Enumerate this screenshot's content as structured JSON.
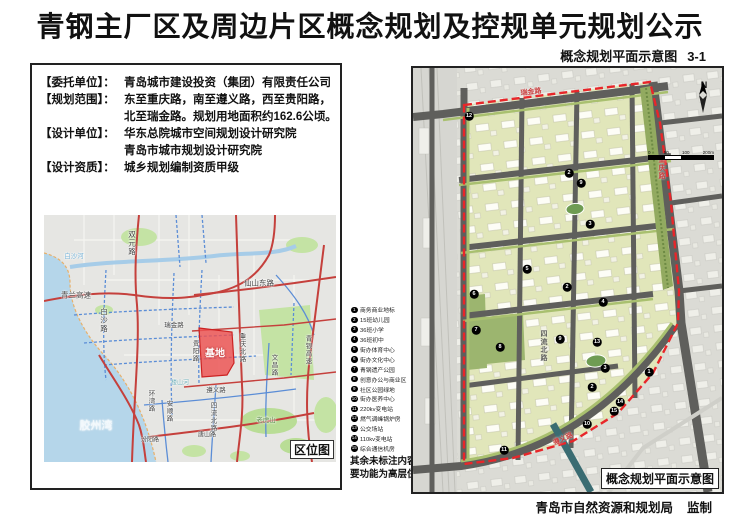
{
  "page": {
    "title": "青钢主厂区及周边片区概念规划及控规单元规划公示",
    "subtitle": "概念规划平面示意图",
    "sheet_no": "3-1",
    "publisher": "青岛市自然资源和规划局",
    "publisher_role": "监制"
  },
  "info_panel": {
    "lines": [
      {
        "label": "【委托单位】：",
        "text": "青岛城市建设投资（集团）有限责任公司"
      },
      {
        "label": "【规划范围】：",
        "text": "东至重庆路，南至遵义路，西至贵阳路，"
      },
      {
        "label": "",
        "text": "北至瑞金路。规划用地面积约162.6公顷。"
      },
      {
        "label": "【设计单位】：",
        "text": "华东总院城市空间规划设计研究院"
      },
      {
        "label": "",
        "text": "青岛市城市规划设计研究院"
      },
      {
        "label": "【设计资质】：",
        "text": "城乡规划编制资质甲级"
      }
    ]
  },
  "location_map": {
    "caption": "区位图",
    "site_label": "基地",
    "labels": [
      {
        "text": "双元路",
        "x": 88,
        "y": 28,
        "vertical": true
      },
      {
        "text": "白沙河",
        "x": 30,
        "y": 40,
        "color": "#79b4d8",
        "size": 6.5
      },
      {
        "text": "青兰高速",
        "x": 32,
        "y": 80
      },
      {
        "text": "白沙路",
        "x": 60,
        "y": 105,
        "vertical": true
      },
      {
        "text": "仙山东路",
        "x": 215,
        "y": 68
      },
      {
        "text": "瑞金路",
        "x": 130,
        "y": 109,
        "size": 6.5
      },
      {
        "text": "贵阳路",
        "x": 150,
        "y": 136,
        "vertical": true,
        "size": 6.5
      },
      {
        "text": "重庆北路",
        "x": 197,
        "y": 133,
        "vertical": true,
        "size": 6.5
      },
      {
        "text": "文昌路",
        "x": 229,
        "y": 150,
        "vertical": true,
        "size": 6.5
      },
      {
        "text": "遵义路",
        "x": 172,
        "y": 174,
        "size": 6.5
      },
      {
        "text": "楼山河",
        "x": 136,
        "y": 167,
        "color": "#6fb0ba",
        "size": 6
      },
      {
        "text": "四流北路",
        "x": 168,
        "y": 202,
        "vertical": true,
        "size": 6.5
      },
      {
        "text": "环湾路",
        "x": 106,
        "y": 186,
        "vertical": true,
        "size": 6.5
      },
      {
        "text": "安顺路",
        "x": 124,
        "y": 196,
        "vertical": true,
        "size": 6.5
      },
      {
        "text": "汾阳路",
        "x": 106,
        "y": 224,
        "size": 6
      },
      {
        "text": "唐山路",
        "x": 163,
        "y": 219,
        "size": 6
      },
      {
        "text": "老虎山",
        "x": 222,
        "y": 204,
        "color": "#5a8a46",
        "size": 6.5
      },
      {
        "text": "青银高速",
        "x": 263,
        "y": 135,
        "vertical": true,
        "size": 6.5
      },
      {
        "text": "胶州湾",
        "x": 52,
        "y": 210,
        "color": "#f2f8fc",
        "size": 11
      }
    ]
  },
  "legend": {
    "items": [
      {
        "num": "1",
        "label": "商务商业地标"
      },
      {
        "num": "2",
        "label": "15班幼儿园"
      },
      {
        "num": "3",
        "label": "36班小学"
      },
      {
        "num": "4",
        "label": "36班初中"
      },
      {
        "num": "5",
        "label": "街办体育中心"
      },
      {
        "num": "6",
        "label": "街办文化中心"
      },
      {
        "num": "7",
        "label": "青钢遗产公园"
      },
      {
        "num": "8",
        "label": "创意办公与商业区"
      },
      {
        "num": "9",
        "label": "社区公园绿地"
      },
      {
        "num": "10",
        "label": "街办医养中心"
      },
      {
        "num": "11",
        "label": "220kv变电站"
      },
      {
        "num": "12",
        "label": "燃气调峰锅炉房"
      },
      {
        "num": "13",
        "label": "公交场站"
      },
      {
        "num": "14",
        "label": "110kv变电站"
      },
      {
        "num": "15",
        "label": "综合通信机房"
      }
    ],
    "note": [
      "其余未标注内容主",
      "要功能为高层住宅"
    ]
  },
  "plan_map": {
    "caption": "概念规划平面示意图",
    "north_label": "N",
    "scale_labels": [
      "0",
      "50",
      "100",
      "200m"
    ],
    "road_labels": [
      {
        "text": "瑞金路",
        "x": 118,
        "y": 24,
        "rot": -7,
        "color": "#c94040"
      },
      {
        "text": "重庆路",
        "x": 248,
        "y": 100,
        "vertical": true,
        "color": "#c94040"
      },
      {
        "text": "四流北路",
        "x": 130,
        "y": 278,
        "vertical": true,
        "color": "#5f5f5c"
      },
      {
        "text": "遵义路",
        "x": 150,
        "y": 371,
        "rot": -24,
        "color": "#c94040"
      }
    ],
    "markers": [
      {
        "num": "12",
        "x": 56,
        "y": 48
      },
      {
        "num": "2",
        "x": 156,
        "y": 105
      },
      {
        "num": "9",
        "x": 168,
        "y": 115
      },
      {
        "num": "3",
        "x": 177,
        "y": 156
      },
      {
        "num": "5",
        "x": 114,
        "y": 201
      },
      {
        "num": "2",
        "x": 154,
        "y": 219
      },
      {
        "num": "6",
        "x": 61,
        "y": 226
      },
      {
        "num": "4",
        "x": 190,
        "y": 234
      },
      {
        "num": "7",
        "x": 63,
        "y": 262
      },
      {
        "num": "9",
        "x": 147,
        "y": 271
      },
      {
        "num": "13",
        "x": 184,
        "y": 274
      },
      {
        "num": "8",
        "x": 87,
        "y": 279
      },
      {
        "num": "3",
        "x": 192,
        "y": 300
      },
      {
        "num": "1",
        "x": 236,
        "y": 304
      },
      {
        "num": "2",
        "x": 179,
        "y": 319
      },
      {
        "num": "14",
        "x": 207,
        "y": 334
      },
      {
        "num": "15",
        "x": 201,
        "y": 343
      },
      {
        "num": "10",
        "x": 174,
        "y": 356
      },
      {
        "num": "11",
        "x": 91,
        "y": 382
      }
    ]
  }
}
